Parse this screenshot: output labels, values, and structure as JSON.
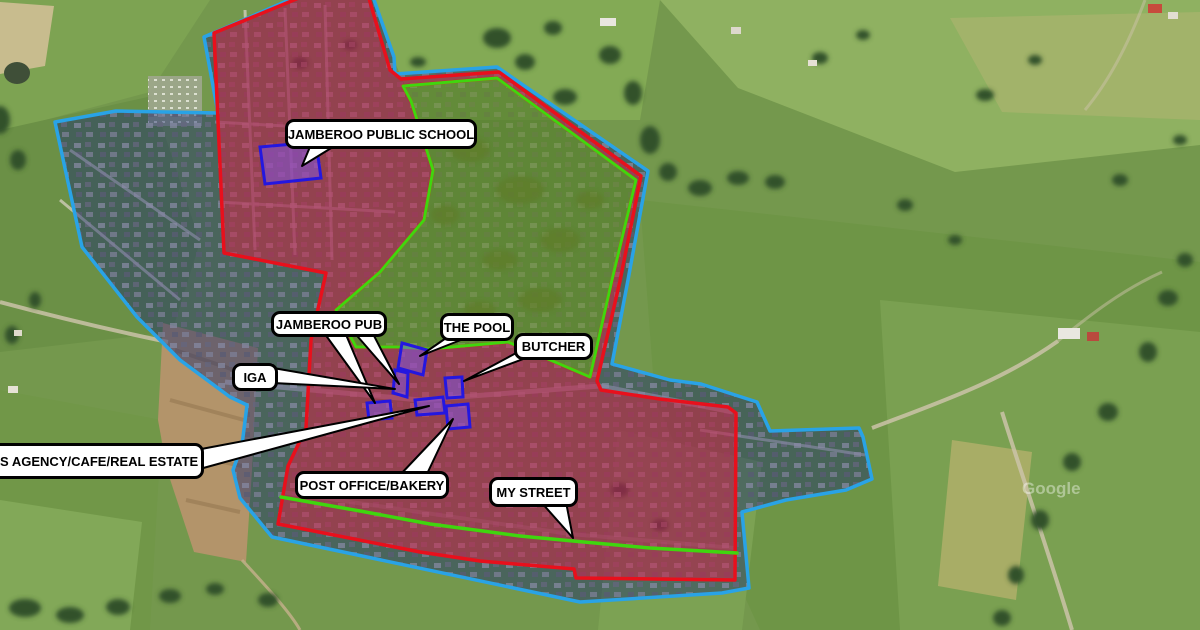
{
  "map": {
    "type": "satellite-annotated-town-map",
    "watermark": "Google",
    "labels": [
      {
        "id": "school",
        "text": "JAMBEROO PUBLIC SCHOOL"
      },
      {
        "id": "pub",
        "text": "JAMBEROO PUB"
      },
      {
        "id": "pool",
        "text": "THE POOL"
      },
      {
        "id": "butcher",
        "text": "BUTCHER"
      },
      {
        "id": "iga",
        "text": "IGA"
      },
      {
        "id": "agency",
        "text": "WS AGENCY/CAFE/REAL ESTATE"
      },
      {
        "id": "post_office",
        "text": "POST OFFICE/BAKERY"
      },
      {
        "id": "my_street",
        "text": "MY STREET"
      }
    ],
    "zones": [
      {
        "id": "blue-zone",
        "boundary_color": "#29a3e6",
        "fill": "rgba(25,40,110,0.45)"
      },
      {
        "id": "red-zone",
        "boundary_color": "#e8101c",
        "fill": "rgba(220,30,65,0.50)"
      },
      {
        "id": "park-zone",
        "boundary_color": "#3fd60e",
        "fill": "rgba(115,165,18,0.50)"
      },
      {
        "id": "my-street-line",
        "boundary_color": "#3fd60e"
      }
    ],
    "building_markers": [
      {
        "id": "school-building",
        "stroke": "#2417e0",
        "fill": "rgba(125,85,235,0.5)"
      },
      {
        "id": "pool-building",
        "stroke": "#2417e0",
        "fill": "rgba(125,85,235,0.5)"
      },
      {
        "id": "iga-building",
        "stroke": "#2417e0",
        "fill": "rgba(125,85,235,0.5)"
      },
      {
        "id": "butcher-building",
        "stroke": "#2417e0",
        "fill": "rgba(125,85,235,0.5)"
      },
      {
        "id": "pub-building",
        "stroke": "#2417e0",
        "fill": "rgba(125,85,235,0.5)"
      },
      {
        "id": "agency-building",
        "stroke": "#2417e0",
        "fill": "rgba(125,85,235,0.5)"
      },
      {
        "id": "post-office-building",
        "stroke": "#2417e0",
        "fill": "rgba(125,85,235,0.5)"
      }
    ],
    "label_style": {
      "bg": "#ffffff",
      "border": "#000000",
      "text_color": "#000000"
    }
  }
}
